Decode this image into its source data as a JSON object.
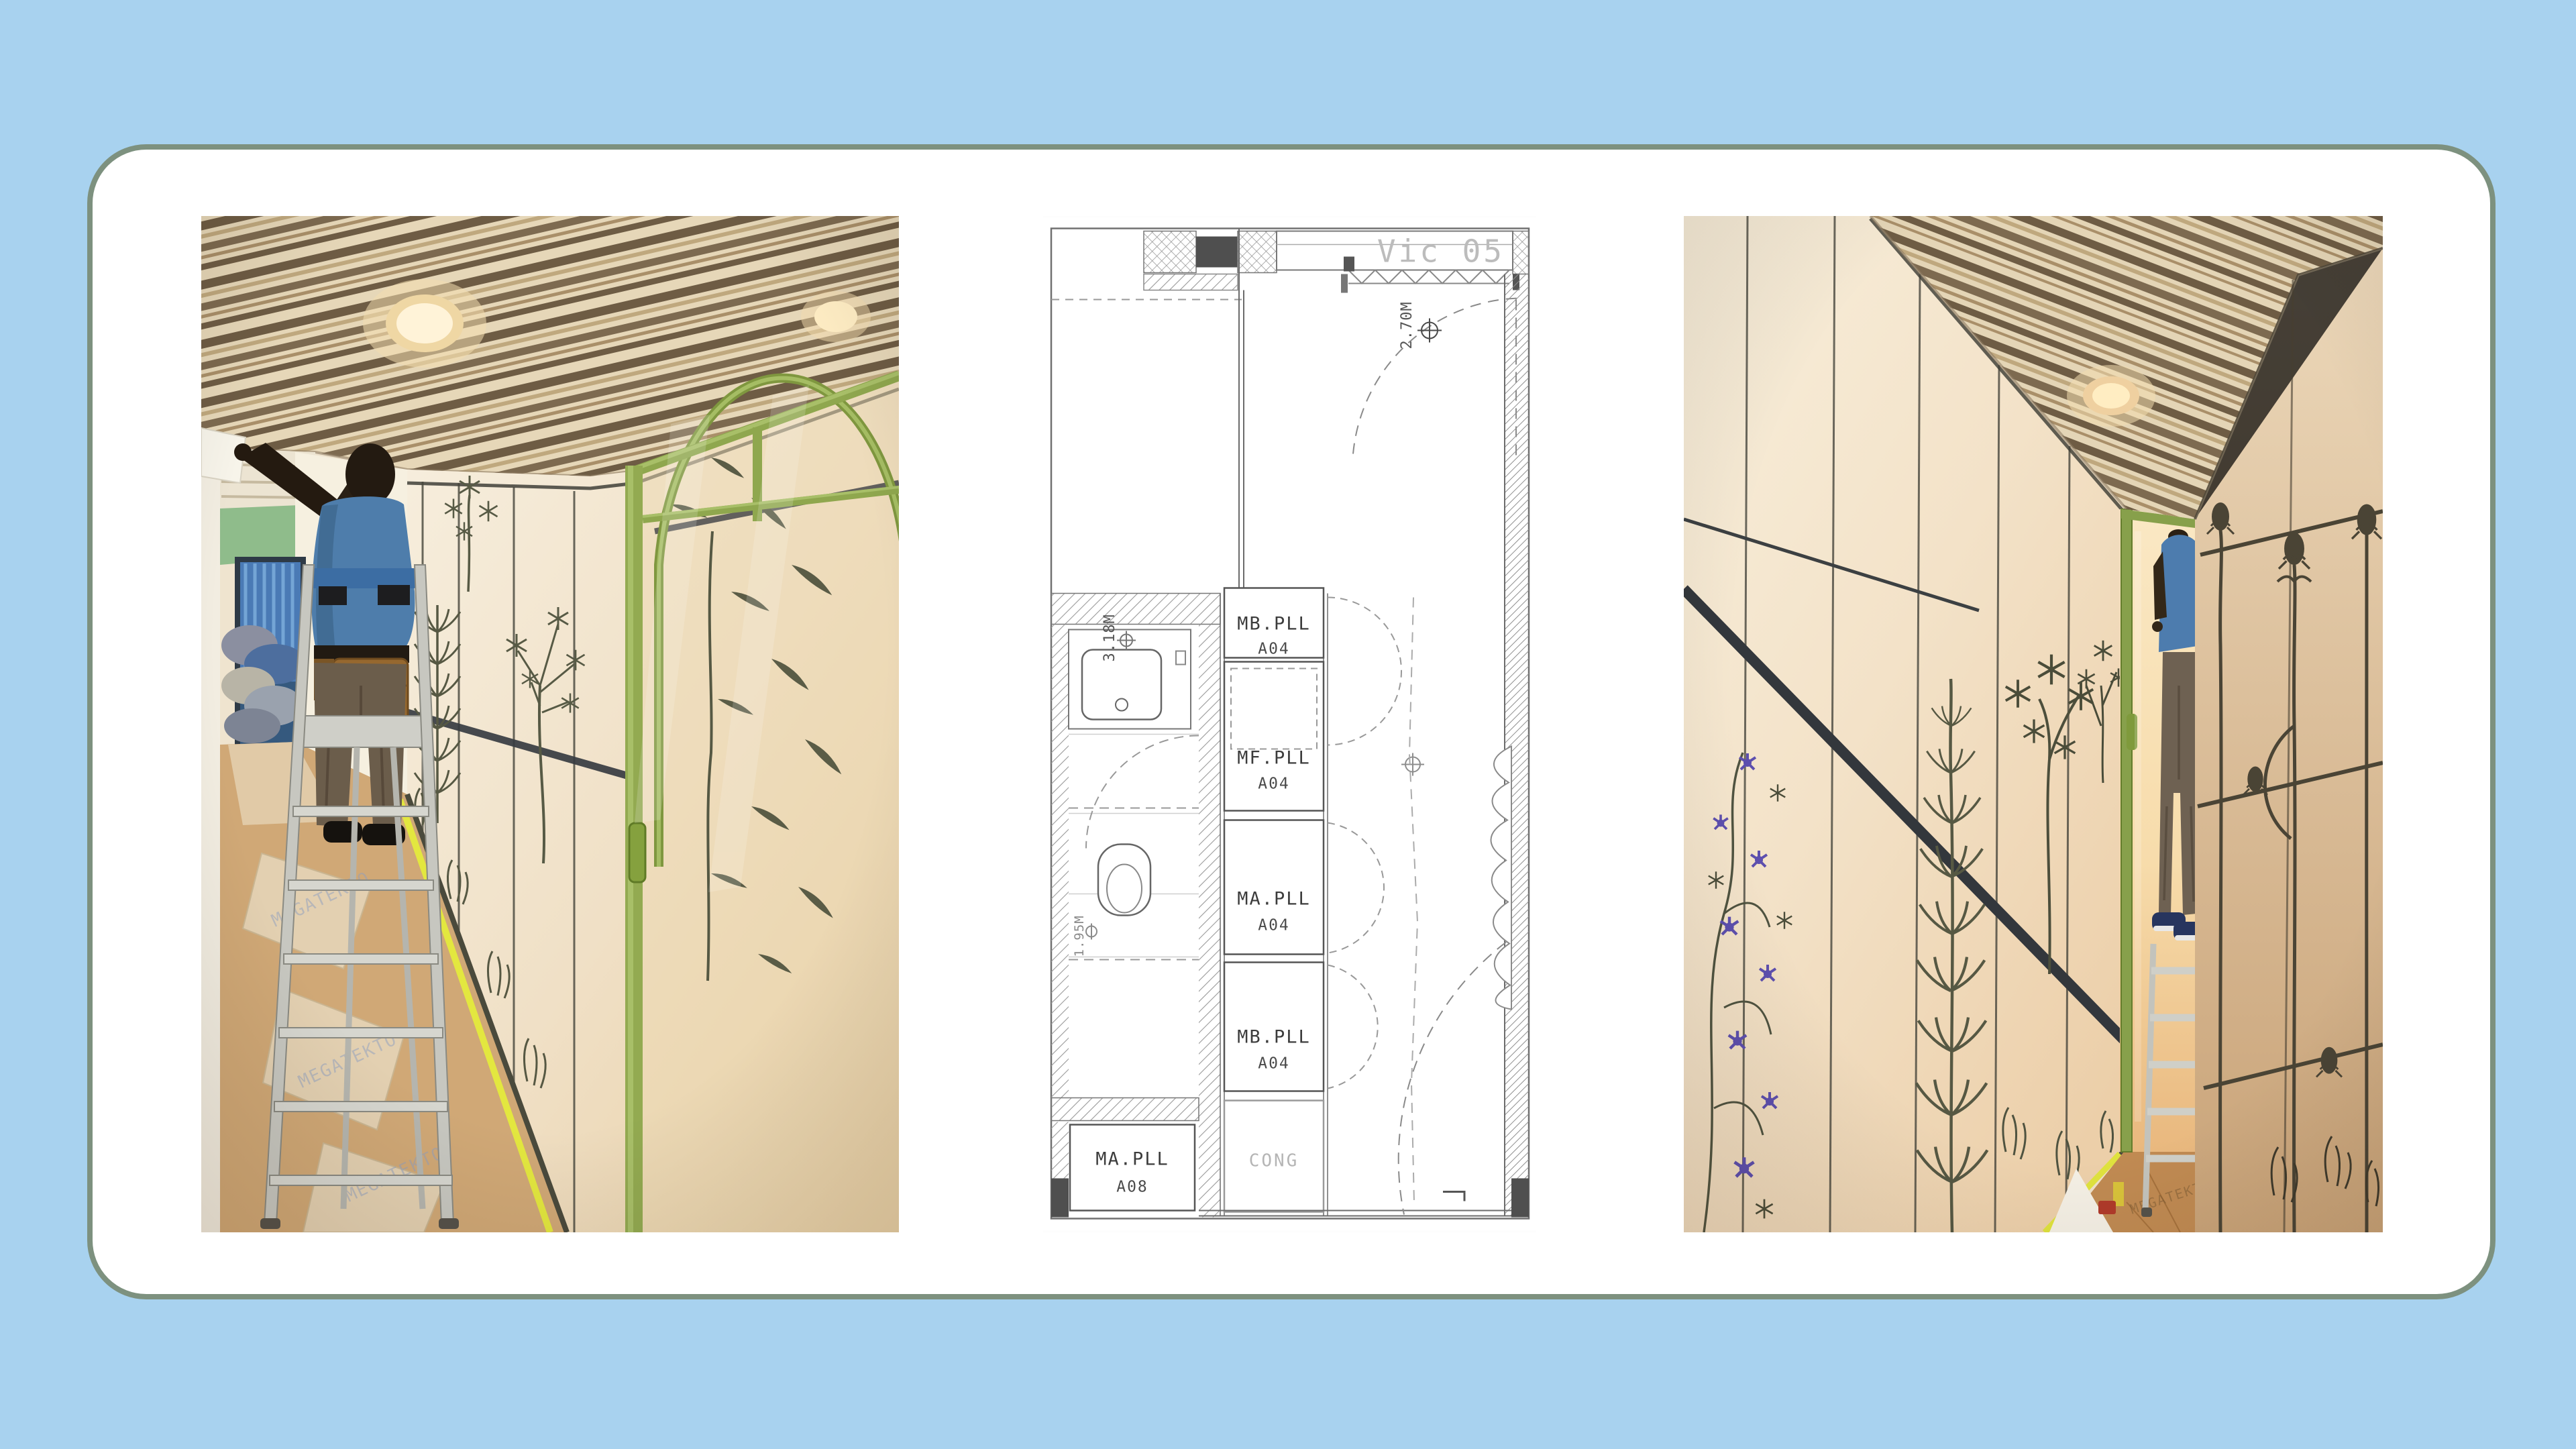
{
  "shared": {
    "floor_paper_brand": "MEGATEKTO"
  },
  "layout": {
    "page_bg": "#a8d2ef",
    "card_bg": "#ffffff",
    "card_border": "#7d917f",
    "accent_green": "#9ab257",
    "tape_yellow": "#e3e73f",
    "shirt_blue": "#4e7dab"
  },
  "floor_plan": {
    "unit_tag": "Vic 05",
    "dims": [
      "2.70M",
      "3.18M",
      "1.95M"
    ],
    "tags": [
      {
        "l1": "MB.PLL",
        "l2": "A04"
      },
      {
        "l1": "MF.PLL",
        "l2": "A04"
      },
      {
        "l1": "MA.PLL",
        "l2": "A04"
      },
      {
        "l1": "MB.PLL",
        "l2": "A04"
      },
      {
        "l1": "MA.PLL",
        "l2": "A08"
      },
      {
        "l1": "CONG",
        "l2": ""
      }
    ]
  }
}
